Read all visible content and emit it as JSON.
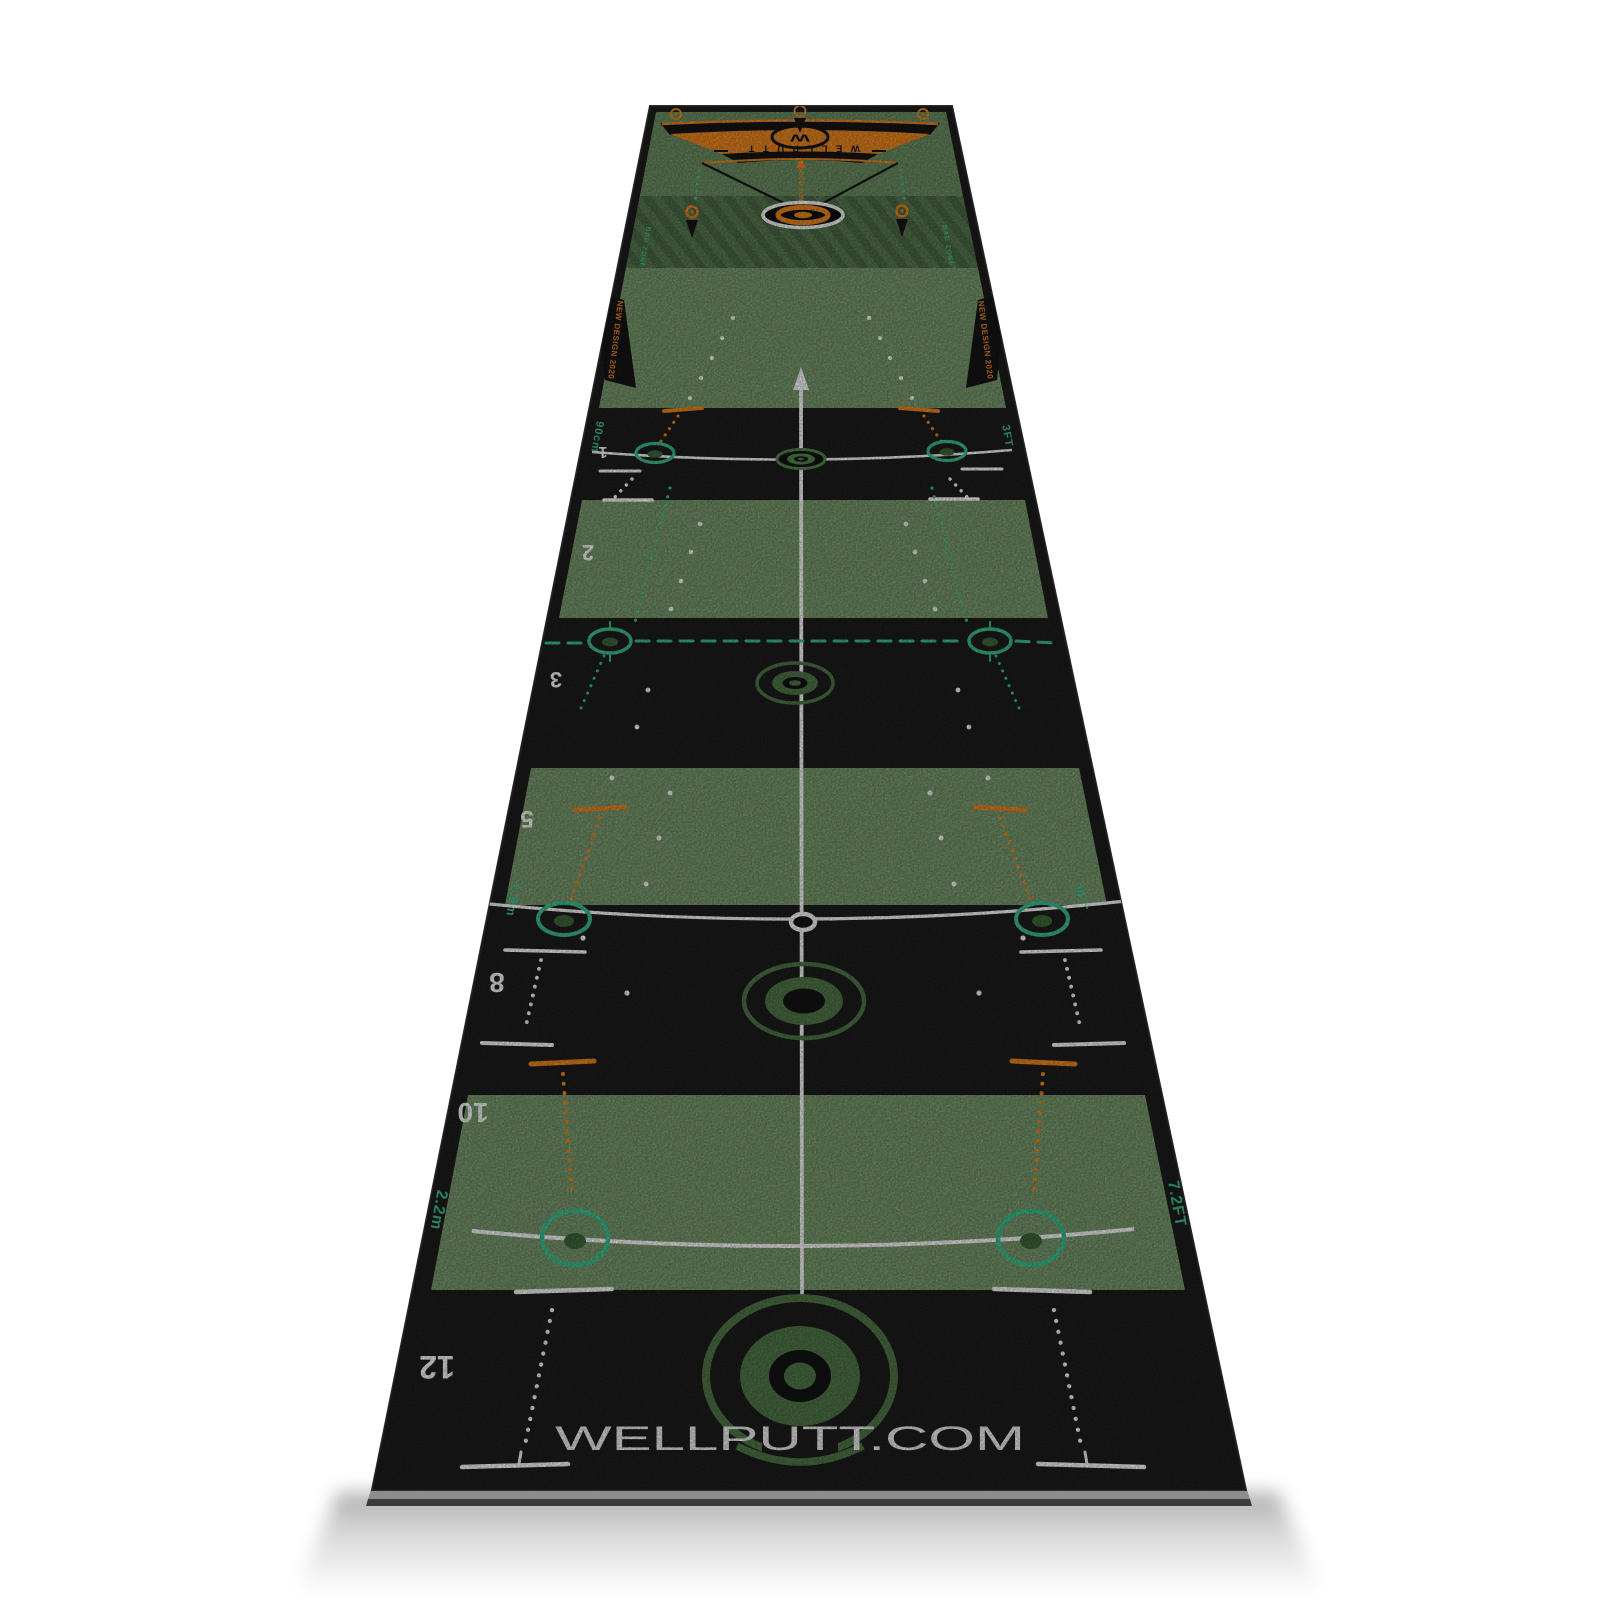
{
  "labels": {
    "brand": "WELLPUTT",
    "monogram": "W",
    "good_zone": "GOOD ZONE",
    "bad_zone": "BAD ZONE",
    "new_design": "NEW DESIGN 2020",
    "website": "WELLPUTT.COM"
  },
  "zones": {
    "z1": {
      "num": "1",
      "left": "90cm",
      "right": "3FT"
    },
    "z2": {
      "num": "2"
    },
    "z3": {
      "num": "3"
    },
    "z5": {
      "num": "5",
      "left": "1.8m",
      "right": "6FT"
    },
    "z8": {
      "num": "8"
    },
    "z10": {
      "num": "10",
      "left": "2.2m",
      "right": "7.2FT"
    },
    "z12": {
      "num": "12"
    }
  },
  "colors": {
    "orange": "#f18a21",
    "teal": "#3ec493",
    "panel_green": "#7c9d70",
    "top_panel_green": "#6e9164",
    "bad_zone_green": "#5a7c52",
    "bad_zone_stripe": "#4e6c47",
    "logo_green": "#527a4a",
    "target_green": "#568c4e",
    "mat_black": "#1d1e1d",
    "white": "#ffffff",
    "background": "#ffffff"
  }
}
